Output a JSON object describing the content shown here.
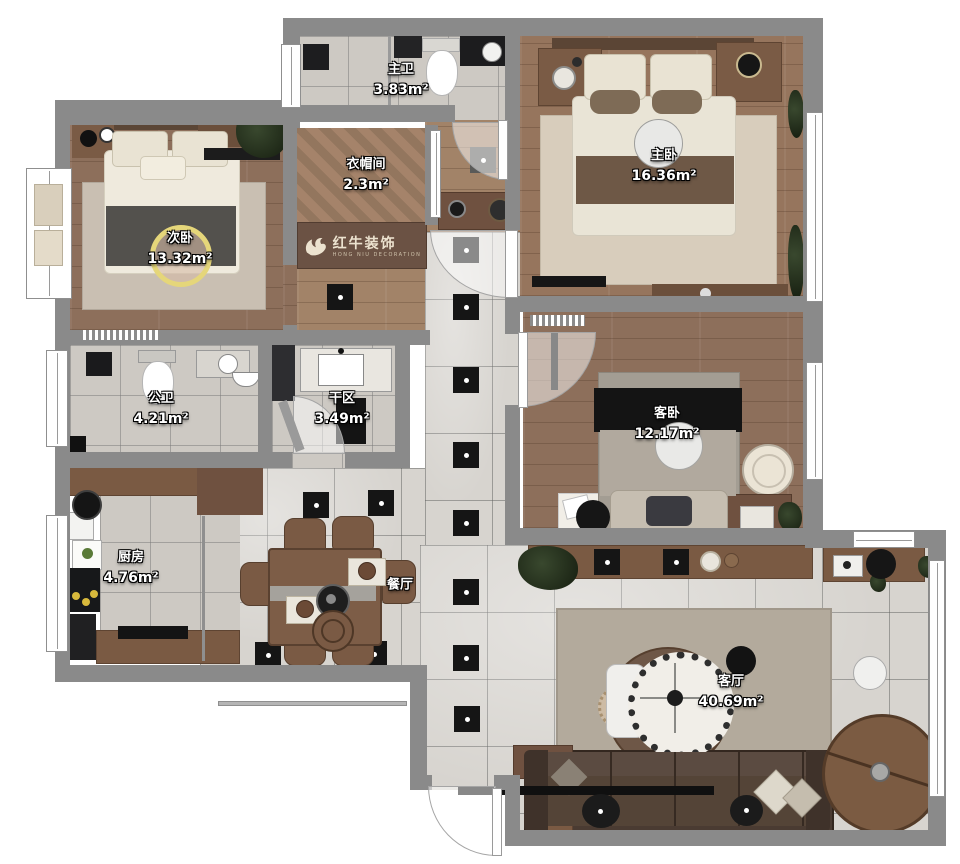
{
  "logo": {
    "cn": "红牛装饰",
    "en": "HONG NIU DECORATION"
  },
  "rooms": {
    "master_bath": {
      "name": "主卫",
      "area": "3.83m²"
    },
    "cloakroom": {
      "name": "衣帽间",
      "area": "2.3m²"
    },
    "master_bedroom": {
      "name": "主卧",
      "area": "16.36m²"
    },
    "second_bedroom": {
      "name": "次卧",
      "area": "13.32m²"
    },
    "public_bath": {
      "name": "公卫",
      "area": "4.21m²"
    },
    "dry_area": {
      "name": "干区",
      "area": "3.49m²"
    },
    "kitchen": {
      "name": "厨房",
      "area": "4.76m²"
    },
    "dining": {
      "name": "餐厅",
      "area": ""
    },
    "guest_bedroom": {
      "name": "客卧",
      "area": "12.17m²"
    },
    "living": {
      "name": "客厅",
      "area": "40.69m²"
    }
  },
  "colors": {
    "wall": "#8a8a8a",
    "wood_floor": "#96755d",
    "tile_floor": "#d7d4cf",
    "accent_tile": "#151515",
    "label_text": "#ffffff",
    "logo_board": "#6b5244"
  }
}
